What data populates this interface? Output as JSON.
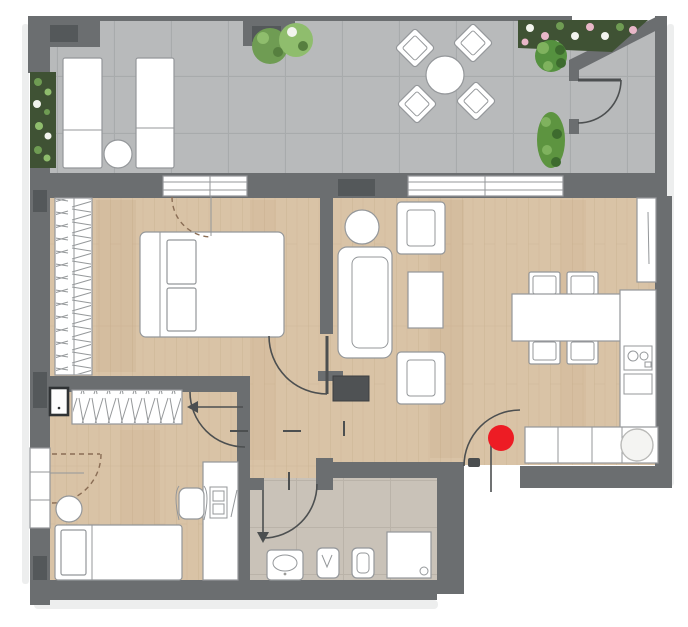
{
  "meta": {
    "kind": "apartment-floor-plan",
    "canvas_width": 688,
    "canvas_height": 627,
    "visible_text": "none"
  },
  "colors": {
    "wall": "#6b6e70",
    "wall-dark": "#54585a",
    "terrace-tile": "#b8babb",
    "terrace-line": "#a8abac",
    "wood": "#d9c3a6",
    "wood-line": "#c8b090",
    "bath-tile": "#c9c2b8",
    "bath-line": "#bab3a9",
    "furn": "#ffffff",
    "outline": "#94979a",
    "door": "#4c4f50",
    "tv": "#4f5254",
    "plant-dark": "#3f5234",
    "plant-mid": "#6f9c53",
    "plant-light": "#8fbd6d",
    "flower-pink": "#e8b7c8",
    "flower-white": "#f2f4ee",
    "marker-red": "#ed1c24"
  },
  "marker": {
    "x": 501,
    "y": 438,
    "r": 13
  },
  "rooms": [
    "terrace",
    "bedroom",
    "living-dining-room",
    "kitchen",
    "hallway",
    "second-bedroom",
    "bathroom"
  ],
  "furniture": {
    "terrace": [
      "sun-lounger",
      "sun-lounger",
      "side-table-round",
      "round-dining-table",
      "chair",
      "chair",
      "chair",
      "chair",
      "planter-hedge",
      "shrubs",
      "flower-bed",
      "fern-plant",
      "tall-plant"
    ],
    "bedroom": [
      "double-bed",
      "pillow",
      "pillow",
      "wardrobe-hatched"
    ],
    "living-dining-room": [
      "sofa",
      "armchair",
      "armchair",
      "coffee-table",
      "round-side-table",
      "tv-unit",
      "dining-table",
      "dining-chair",
      "dining-chair",
      "dining-chair",
      "dining-chair"
    ],
    "kitchen": [
      "tall-cabinet",
      "counter-right",
      "cooktop-2-burner",
      "oven",
      "counter-bottom",
      "round-sink"
    ],
    "hallway": [
      "hall-closet-hatched",
      "wall-panel-box"
    ],
    "second-bedroom": [
      "single-bed",
      "pillow",
      "pouf-round",
      "desk",
      "office-chair",
      "desk-monitor"
    ],
    "bathroom": [
      "washbasin",
      "bidet",
      "toilet",
      "shower-tray"
    ]
  },
  "doors": [
    "terrace-corner-door",
    "bedroom-terrace-door-dashed",
    "bedroom-door",
    "second-bedroom-door",
    "second-bedroom-window-door-dashed",
    "bathroom-door",
    "entrance-door"
  ]
}
